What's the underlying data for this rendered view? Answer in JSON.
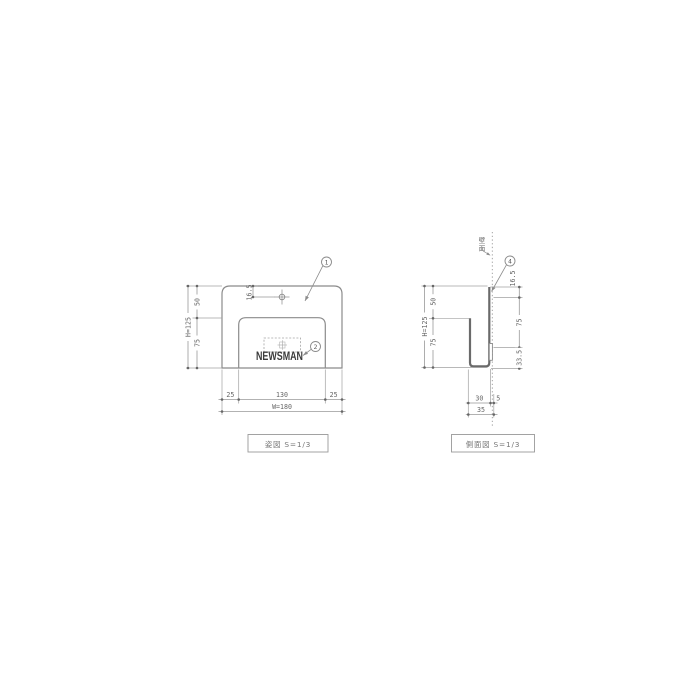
{
  "drawing": {
    "front_view": {
      "caption": "姿図 S=1/3",
      "logo": "NEWSMAN",
      "callout_1": "1",
      "callout_2": "2",
      "dim_hole_offset": "16.5",
      "dim_upper_height": "50",
      "dim_lower_height": "75",
      "dim_total_height": "H=125",
      "dim_left_margin": "25",
      "dim_pocket_width": "130",
      "dim_right_margin": "25",
      "dim_total_width": "W=180"
    },
    "side_view": {
      "caption": "側面図 S=1/3",
      "wall_label": "壁面",
      "callout_4": "4",
      "dim_upper_height": "50",
      "dim_lower_height": "75",
      "dim_total_height": "H=125",
      "dim_hole_offset": "16.5",
      "dim_mid_height": "75",
      "dim_tape_height": "33.5",
      "dim_inner_depth": "30",
      "dim_wall_gap": "5",
      "dim_total_depth": "35"
    },
    "colors": {
      "outline": "#8b8b8b",
      "profile": "#6a6a6a",
      "dim_line": "#999999",
      "text": "#666666"
    }
  }
}
